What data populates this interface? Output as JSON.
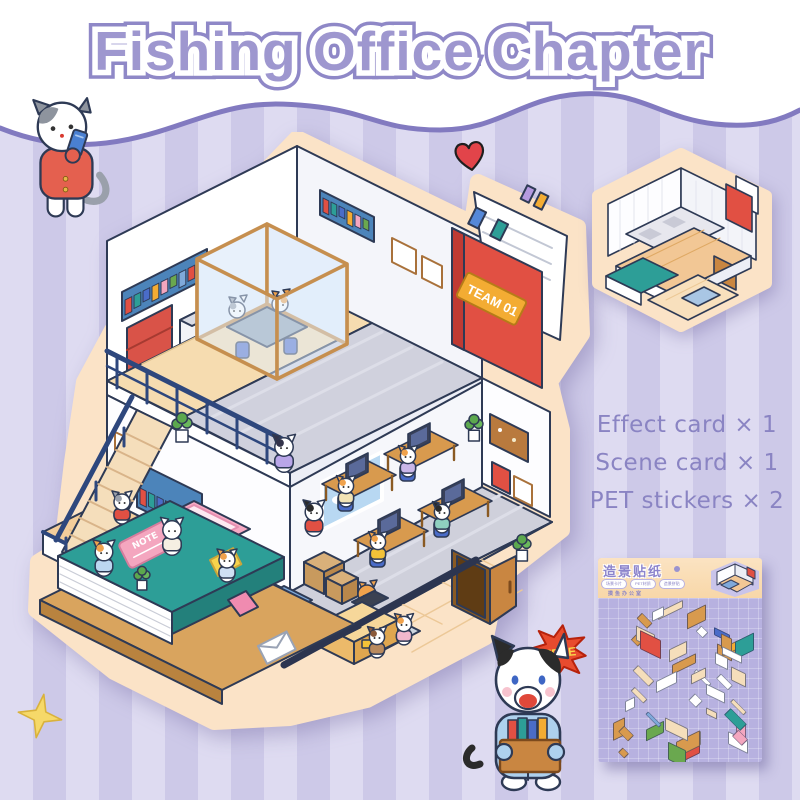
{
  "title": "Fishing Office Chapter",
  "contents": {
    "items": [
      {
        "label": "Effect card × 1"
      },
      {
        "label": "Scene card × 1"
      },
      {
        "label": "PET stickers × 2"
      }
    ]
  },
  "main_scene": {
    "team_plaque": "TEAM 01",
    "note_label": "NOTE",
    "free_badge": "FREE"
  },
  "sticker_sheet": {
    "title": "造景贴纸",
    "badges": [
      {
        "label": "场景卡片"
      },
      {
        "label": "PET材质"
      },
      {
        "label": "造景拼贴"
      }
    ],
    "series": "摸鱼办公室"
  },
  "colors": {
    "stripe_light": "#dedbf1",
    "stripe_dark": "#cdc9e8",
    "wave_line": "#827ac0",
    "title_fill": "#9e97cf",
    "title_outline": "#8f88c7",
    "text_purple": "#8a84c3",
    "sticker_border": "#fbe3c7",
    "outline_navy": "#2e3a55",
    "red": "#e15043",
    "plaque_yellow": "#f3ac33",
    "teal_book": "#2d9e97",
    "wood": "#d89a4e",
    "wood_light": "#f2c795",
    "navy_rail": "#2e477d",
    "shelf_blue": "#4c84ba",
    "chair_blue": "#4a6cc8",
    "pink": "#f4a6bf",
    "sheet_header": "#f8d7a8",
    "sheet_body": "#b7b1e0",
    "free_red": "#e84b2e",
    "heart_red": "#e2444a",
    "star_yellow": "#f6d969",
    "stair_beige": "#f5debb",
    "stairs_blue": "#7fa9da",
    "carpet_gray": "#cfd0db",
    "tile_cream": "#f8e0bd"
  }
}
